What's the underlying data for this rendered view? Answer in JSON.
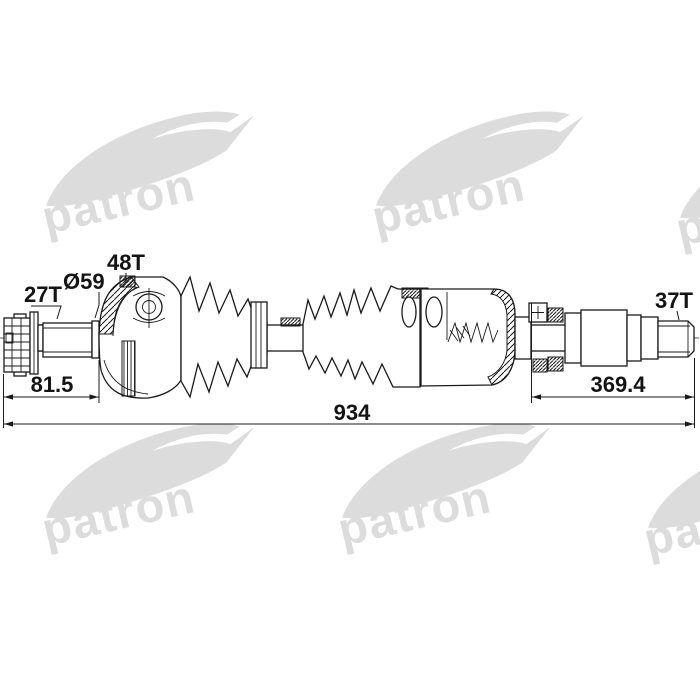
{
  "watermark": {
    "brand": "patron",
    "color": "#dcdcdc"
  },
  "drawing": {
    "part": "drive-shaft-cv-axle",
    "colors": {
      "line": "#1a1a1a",
      "background": "#ffffff"
    },
    "labels": {
      "outer_spline_teeth": "27T",
      "boot_diameter": "Ø59",
      "abs_ring_teeth": "48T",
      "inner_spline_teeth": "37T"
    },
    "dimensions": {
      "outer_joint_length": "81.5",
      "inner_section_length": "369.4",
      "overall_length": "934"
    }
  }
}
